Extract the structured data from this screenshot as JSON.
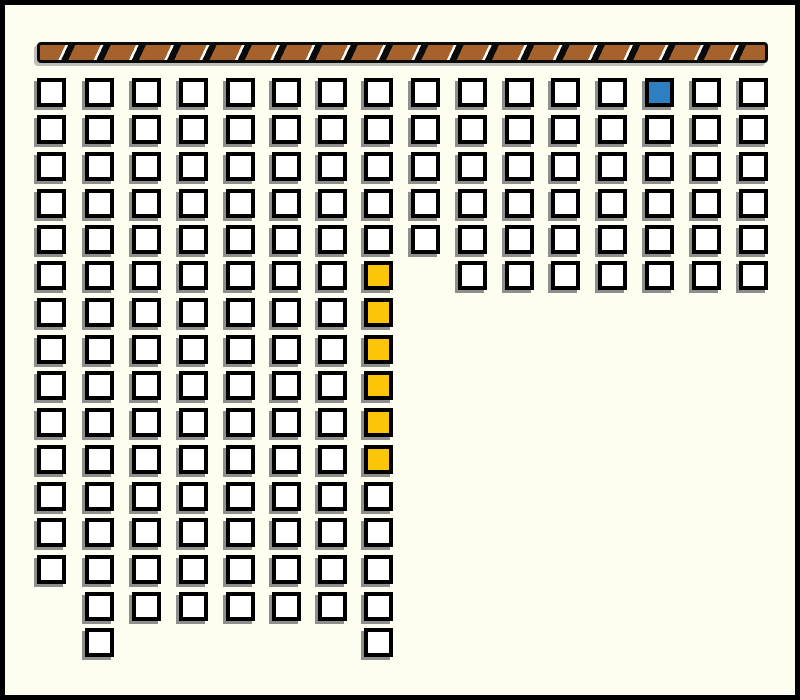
{
  "scene": {
    "width": 800,
    "height": 700,
    "kind": "grid-of-squares-under-hatched-beam"
  },
  "colors": {
    "background": "#FDFDF0",
    "frame_border": "#000000",
    "square_fill": "#FFFFFF",
    "square_border": "#000000",
    "square_shadow": "#8E8E8E",
    "highlight_yellow": "#FCC508",
    "highlight_blue": "#2E7FC2",
    "beam_brown": "#A5622D",
    "beam_black": "#0A0A0A",
    "beam_highlight": "#FFFFFF"
  },
  "beam": {
    "x": 37,
    "y": 42,
    "width": 731,
    "height": 21,
    "stripe_angle_deg": 115,
    "stripe_period": 32,
    "brown_width": 23,
    "white_width": 2.5
  },
  "grid": {
    "square_size": 29,
    "square_border_width": 4,
    "col_x": [
      37,
      85,
      132,
      179,
      226,
      272,
      318,
      364,
      411,
      458,
      505,
      551,
      598,
      645,
      692,
      739
    ],
    "row_y": [
      78,
      115,
      152,
      189,
      225,
      261,
      298,
      335,
      371,
      408,
      445,
      482,
      518,
      555,
      592,
      628
    ],
    "rows": [
      {
        "row": 1,
        "col_ranges": [
          [
            1,
            16
          ]
        ]
      },
      {
        "row": 2,
        "col_ranges": [
          [
            1,
            16
          ]
        ]
      },
      {
        "row": 3,
        "col_ranges": [
          [
            1,
            16
          ]
        ]
      },
      {
        "row": 4,
        "col_ranges": [
          [
            1,
            16
          ]
        ]
      },
      {
        "row": 5,
        "col_ranges": [
          [
            1,
            16
          ]
        ]
      },
      {
        "row": 6,
        "col_ranges": [
          [
            1,
            8
          ],
          [
            10,
            16
          ]
        ]
      },
      {
        "row": 7,
        "col_ranges": [
          [
            1,
            8
          ]
        ]
      },
      {
        "row": 8,
        "col_ranges": [
          [
            1,
            8
          ]
        ]
      },
      {
        "row": 9,
        "col_ranges": [
          [
            1,
            8
          ]
        ]
      },
      {
        "row": 10,
        "col_ranges": [
          [
            1,
            8
          ]
        ]
      },
      {
        "row": 11,
        "col_ranges": [
          [
            1,
            8
          ]
        ]
      },
      {
        "row": 12,
        "col_ranges": [
          [
            1,
            8
          ]
        ]
      },
      {
        "row": 13,
        "col_ranges": [
          [
            1,
            8
          ]
        ]
      },
      {
        "row": 14,
        "col_ranges": [
          [
            1,
            8
          ]
        ]
      },
      {
        "row": 15,
        "col_ranges": [
          [
            2,
            8
          ]
        ]
      },
      {
        "row": 16,
        "col_ranges": [
          [
            2,
            2
          ],
          [
            8,
            8
          ]
        ]
      }
    ],
    "colored_squares": [
      {
        "row": 1,
        "col": 14,
        "color": "blue"
      },
      {
        "row": 6,
        "col": 8,
        "color": "yellow"
      },
      {
        "row": 7,
        "col": 8,
        "color": "yellow"
      },
      {
        "row": 8,
        "col": 8,
        "color": "yellow"
      },
      {
        "row": 9,
        "col": 8,
        "color": "yellow"
      },
      {
        "row": 10,
        "col": 8,
        "color": "yellow"
      },
      {
        "row": 11,
        "col": 8,
        "color": "yellow"
      }
    ],
    "counts": {
      "total_squares": 168,
      "white_squares": 161,
      "yellow_squares": 6,
      "blue_squares": 1
    }
  }
}
